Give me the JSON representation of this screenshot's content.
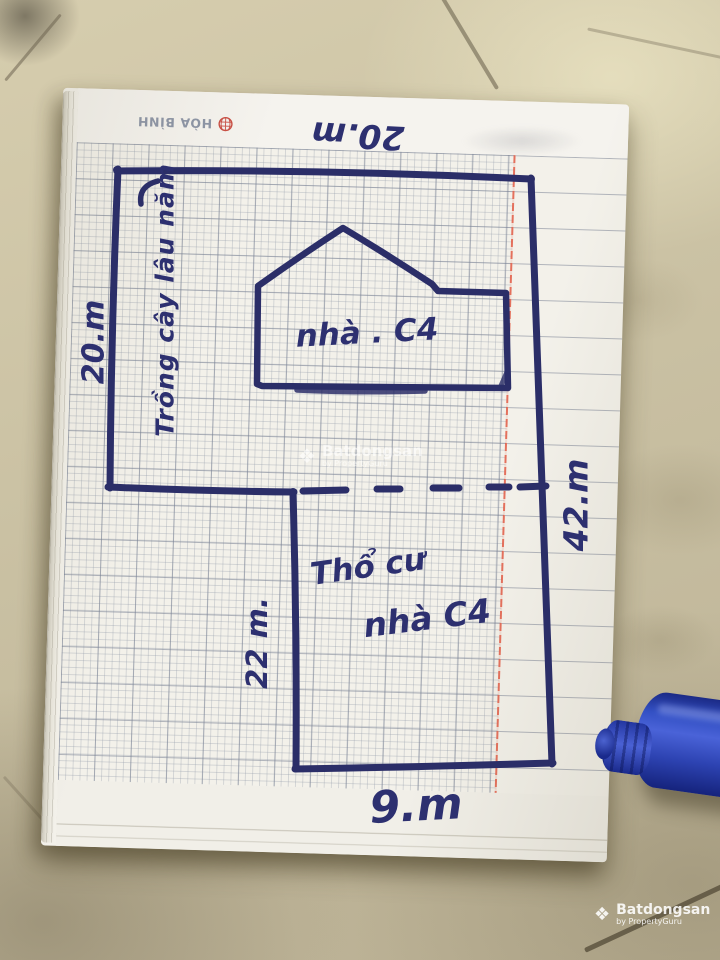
{
  "brand": {
    "label": "HÒA BÌNH"
  },
  "sketch": {
    "type": "hand-drawn land plot sketch on graph paper",
    "dim_top": "20.m",
    "dim_left": "20.m",
    "dim_right": "42.m",
    "dim_inner": "22 m.",
    "dim_bottom": "9.m",
    "zone_upper": "Trồng cây lâu năm",
    "house": "nhà . C4",
    "zone_lower_1": "Thổ cư",
    "zone_lower_2": "nhà C4"
  },
  "watermark": {
    "diamond": "❖",
    "brand": "Batdongsan",
    "sub": "by PropertyGuru"
  },
  "colors": {
    "ink": "#2d3070",
    "margin_red": "#e25a44",
    "pen_blue": "#2f45c0",
    "paper": "#f3f1ea",
    "tile": "#cbc2a4"
  }
}
